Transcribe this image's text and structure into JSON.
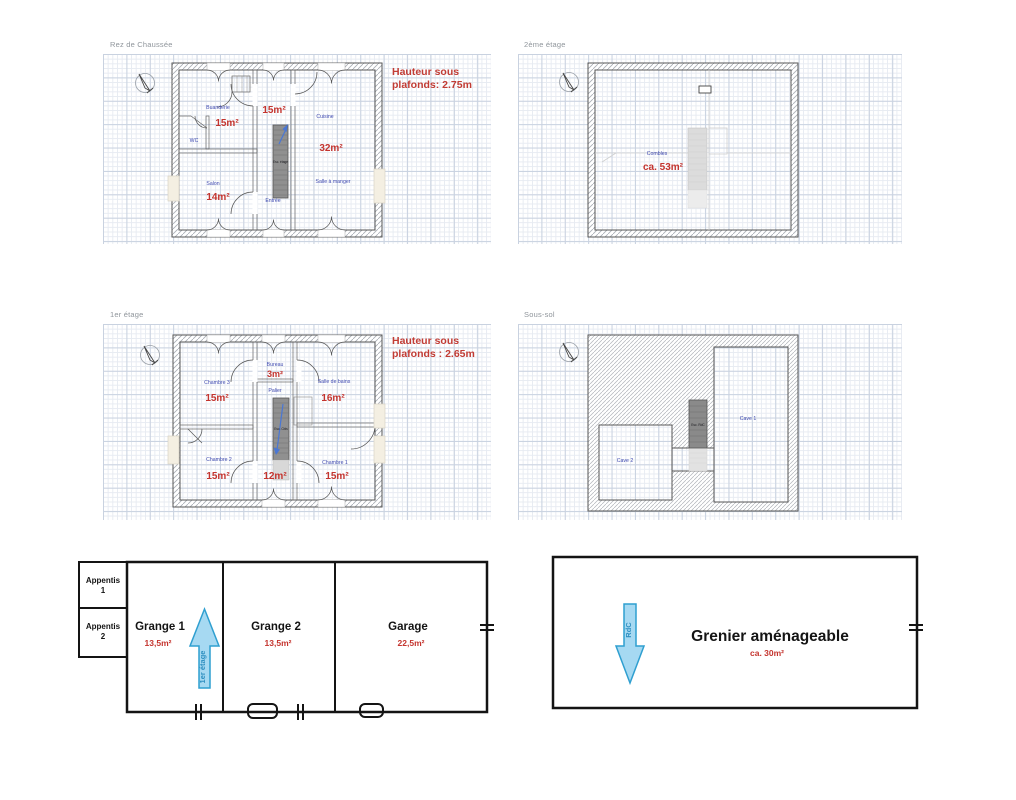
{
  "colors": {
    "area_red": "#c4342e",
    "room_blue": "#3f4ab0",
    "title_gray": "#8f959b",
    "arrow_fill": "#a6d9f2",
    "arrow_stroke": "#2f9fd0",
    "stair_gray": "#909090"
  },
  "plans": {
    "rdc": {
      "title": "Rez de Chaussée",
      "note": {
        "line1": "Hauteur sous",
        "line2": "plafonds: 2.75m"
      },
      "rooms": {
        "buanderie": {
          "name": "Buanderie",
          "area": "15m²"
        },
        "wc": {
          "name": "WC"
        },
        "salon": {
          "name": "Salon",
          "area": "14m²"
        },
        "hall": {
          "area": "15m²"
        },
        "entree": {
          "name": "Entrée"
        },
        "cuisine": {
          "name": "Cuisine",
          "area": "32m²"
        },
        "salle_a_manger": {
          "name": "Salle à manger"
        }
      },
      "stair_label": "Esc. étage"
    },
    "etage2": {
      "title": "2ème étage",
      "rooms": {
        "combles": {
          "name": "Combles",
          "area": "ca. 53m²"
        }
      }
    },
    "etage1": {
      "title": "1er étage",
      "note": {
        "line1": "Hauteur sous",
        "line2": "plafonds : 2.65m"
      },
      "rooms": {
        "chambre3": {
          "name": "Chambre 3",
          "area": "15m²"
        },
        "bureau": {
          "name": "Bureau",
          "area": "3m²"
        },
        "palier": {
          "name": "Palier"
        },
        "salle_de_bains": {
          "name": "Salle de bains",
          "area": "16m²"
        },
        "chambre2": {
          "name": "Chambre 2",
          "area": "15m²"
        },
        "hall": {
          "area": "12m²"
        },
        "chambre1": {
          "name": "Chambre 1",
          "area": "15m²"
        }
      },
      "stair_label": "Esc. Cbls"
    },
    "soussol": {
      "title": "Sous-sol",
      "rooms": {
        "cave1": {
          "name": "Cave 1"
        },
        "cave2": {
          "name": "Cave 2"
        }
      },
      "stair_label": "Esc. RdC"
    }
  },
  "outbuildings": {
    "annex": {
      "appentis1": {
        "line1": "Appentis",
        "line2": "1"
      },
      "appentis2": {
        "line1": "Appentis",
        "line2": "2"
      },
      "grange1": {
        "name": "Grange 1",
        "area": "13,5m²"
      },
      "grange2": {
        "name": "Grange 2",
        "area": "13,5m²"
      },
      "garage": {
        "name": "Garage",
        "area": "22,5m²"
      },
      "arrow_label": "1er étage"
    },
    "grenier": {
      "name": "Grenier aménageable",
      "area": "ca. 30m²",
      "arrow_label": "RdC"
    }
  }
}
